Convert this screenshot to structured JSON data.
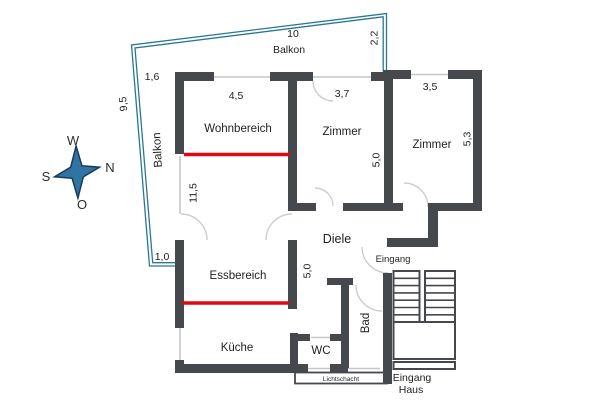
{
  "image": {
    "width": 600,
    "height": 400,
    "background": "#ffffff",
    "description": "apartment floor plan with balcony, compass rose and staircase"
  },
  "colors": {
    "wall": "#45484d",
    "marker_red": "#e30613",
    "balcony_outline": "#2a7795",
    "window_line": "#c6c6c6",
    "compass_fill": "#2f74a4",
    "compass_stroke": "#1b3a57",
    "text": "#1f1f1f"
  },
  "compass": {
    "west": "W",
    "north": "N",
    "south": "S",
    "east": "O"
  },
  "rooms": {
    "wohnbereich": "Wohnbereich",
    "zimmer_1": "Zimmer",
    "zimmer_2": "Zimmer",
    "essbereich": "Essbereich",
    "kueche": "Küche",
    "diele": "Diele",
    "wc": "WC",
    "bad": "Bad"
  },
  "labels": {
    "balkon_top": "Balkon",
    "balkon_left": "Balkon",
    "eingang_wohnung": "Eingang",
    "eingang_haus_line1": "Eingang",
    "eingang_haus_line2": "Haus",
    "lichtschacht": "Lichtschacht"
  },
  "dimensions": {
    "balkon_length": "10",
    "balkon_right_width": "2,2",
    "balkon_left_length": "9,5",
    "top_left_offset": "1,6",
    "balkon_door_width": "1,0",
    "wohnbereich_width": "4,5",
    "living_area_length": "11,5",
    "zimmer_1_width": "3,7",
    "zimmer_1_depth": "5,0",
    "zimmer_2_width": "3,5",
    "zimmer_2_depth": "5,3",
    "diele_length": "5,0"
  }
}
